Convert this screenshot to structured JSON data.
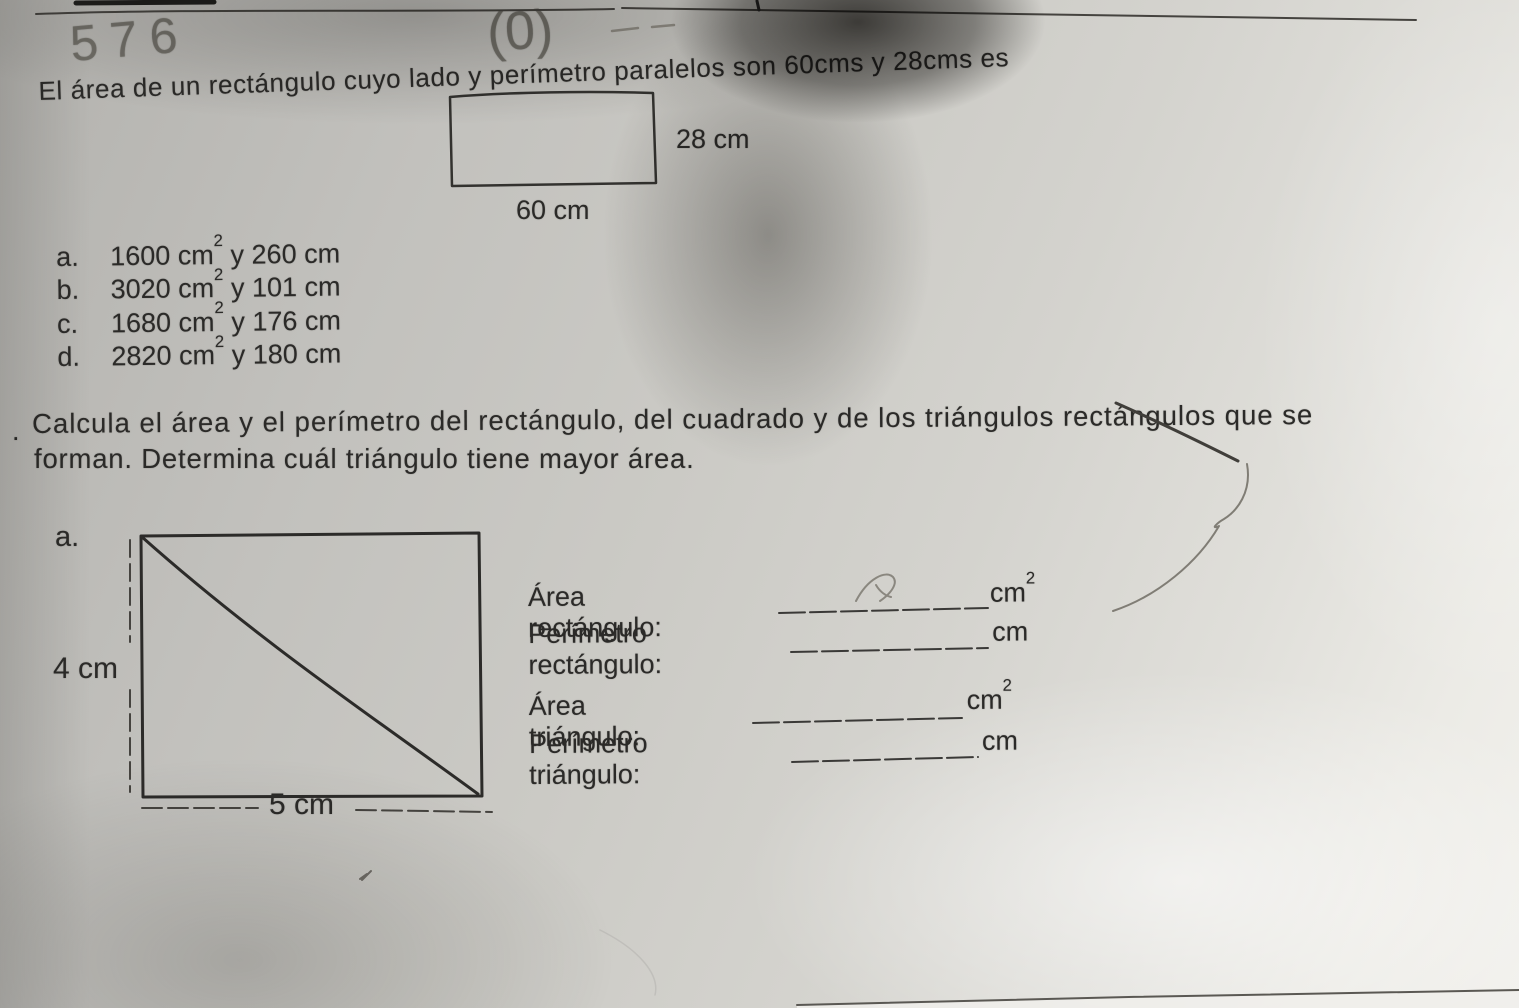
{
  "handwriting": {
    "mark_left": "576",
    "mark_center": "(0)"
  },
  "question1": {
    "text": "El área de un rectángulo cuyo lado y perímetro paralelos son 60cms y 28cms es",
    "figure": {
      "side_label": "28 cm",
      "base_label": "60 cm"
    },
    "options": [
      {
        "letter": "a.",
        "value": "1600 cm",
        "exp": "2",
        "suffix": " y 260 cm"
      },
      {
        "letter": "b.",
        "value": "3020 cm",
        "exp": "2",
        "suffix": " y 101 cm"
      },
      {
        "letter": "c.",
        "value": "1680 cm",
        "exp": "2",
        "suffix": " y 176 cm"
      },
      {
        "letter": "d.",
        "value": "2820 cm",
        "exp": "2",
        "suffix": " y 180 cm"
      }
    ]
  },
  "question2": {
    "bullet": ".",
    "line1": "Calcula el área y el perímetro del rectángulo, del cuadrado y de los triángulos rectángulos que se",
    "line2": "forman. Determina cuál triángulo tiene mayor área.",
    "figure": {
      "item_label": "a.",
      "height_label": "4 cm",
      "base_label": "5 cm"
    },
    "answers": [
      {
        "label": "Área rectángulo:",
        "unit": "cm",
        "exp": "2"
      },
      {
        "label": "Perímetro rectángulo:",
        "unit": "cm",
        "exp": ""
      },
      {
        "label": "Área triángulo:",
        "unit": "cm",
        "exp": "2"
      },
      {
        "label": "Perímetro triángulo:",
        "unit": "cm",
        "exp": ""
      }
    ]
  }
}
